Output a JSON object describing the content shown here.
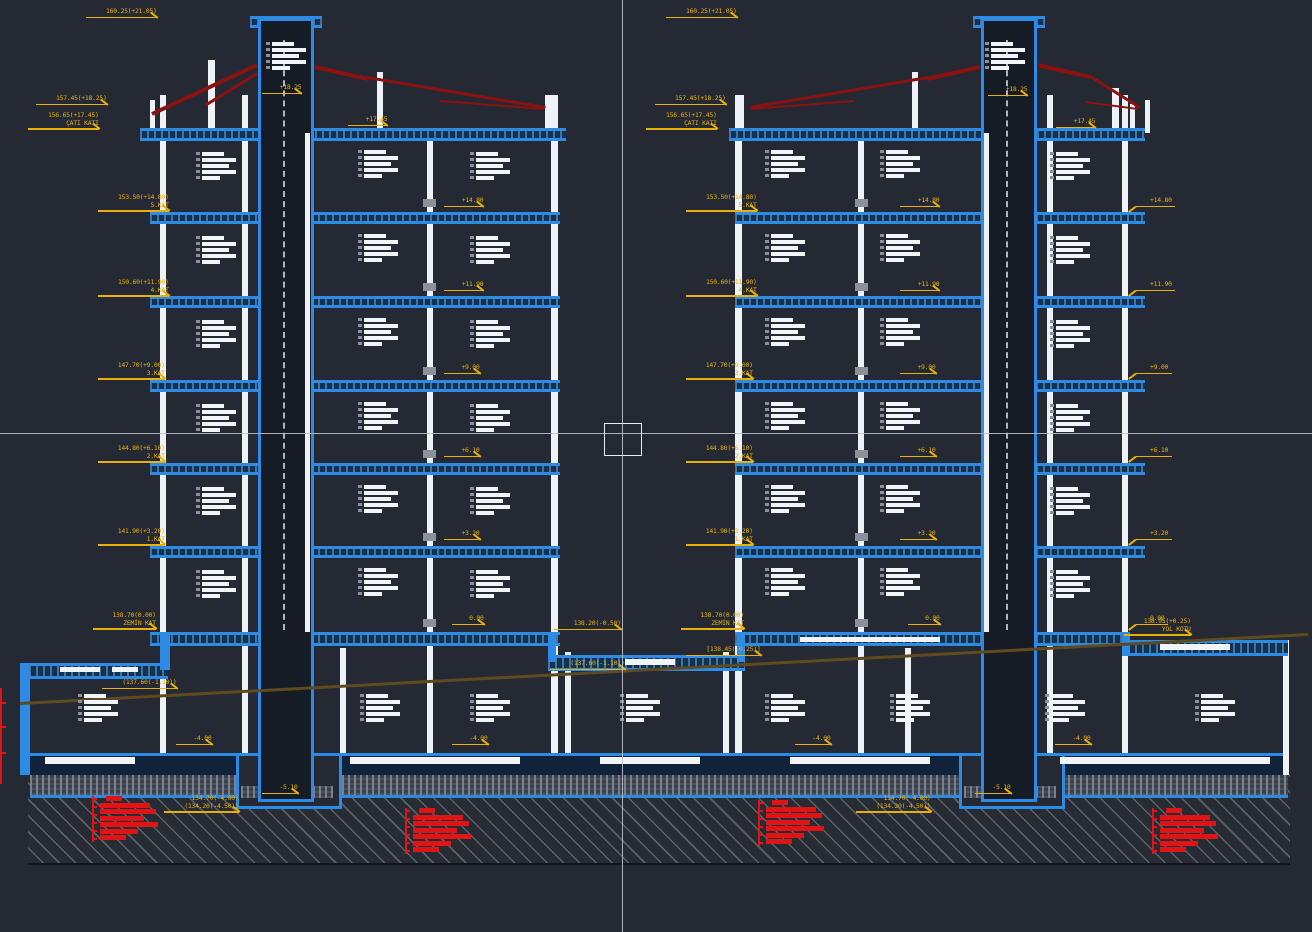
{
  "viewport": {
    "kind": "cad-section-drawing",
    "subject": "building cross-section, two mirrored tower blocks on common basement"
  },
  "colors": {
    "background": "#242933",
    "slab_blue": "#2d8ae5",
    "wall_white": "#eef1f5",
    "label_yellow": "#e9b009",
    "roof_red": "#8c1212",
    "note_red": "#e01414",
    "ground_brown": "#5f4a1f",
    "crosshair": "#b9bec8"
  },
  "cursor": {
    "x": 622,
    "y": 433
  },
  "annotations": [
    {
      "x": 86,
      "y": 8,
      "dir": "r",
      "lines": [
        "160.25(+21.05)"
      ]
    },
    {
      "x": 36,
      "y": 95,
      "dir": "r",
      "lines": [
        "157.45(+18.25)"
      ]
    },
    {
      "x": 28,
      "y": 112,
      "dir": "r",
      "lines": [
        "156.65(+17.45)",
        "ÇATI KATI"
      ]
    },
    {
      "x": 98,
      "y": 194,
      "dir": "r",
      "lines": [
        "153.50(+14.80)",
        "5.KAT"
      ]
    },
    {
      "x": 98,
      "y": 279,
      "dir": "r",
      "lines": [
        "150.60(+11.90)",
        "4.KAT"
      ]
    },
    {
      "x": 98,
      "y": 362,
      "dir": "r",
      "lines": [
        "147.70(+9.00)",
        "3.KAT"
      ]
    },
    {
      "x": 98,
      "y": 445,
      "dir": "r",
      "lines": [
        "144.80(+6.10)",
        "2.KAT"
      ]
    },
    {
      "x": 98,
      "y": 528,
      "dir": "r",
      "lines": [
        "141.90(+3.20)",
        "1.KAT"
      ]
    },
    {
      "x": 93,
      "y": 612,
      "dir": "r",
      "lines": [
        "138.70(0.00)",
        "ZEMİN KAT"
      ]
    },
    {
      "x": 102,
      "y": 679,
      "dir": "r",
      "lines": [
        "(137.60(-1.10))"
      ]
    },
    {
      "x": 164,
      "y": 795,
      "dir": "r",
      "lines": [
        "134.70(-4.00)",
        "(134.20(-4.50))"
      ]
    },
    {
      "x": 666,
      "y": 8,
      "dir": "r",
      "lines": [
        "160.25(+21.05)"
      ]
    },
    {
      "x": 655,
      "y": 95,
      "dir": "r",
      "lines": [
        "157.45(+18.25)"
      ]
    },
    {
      "x": 646,
      "y": 112,
      "dir": "r",
      "lines": [
        "156.65(+17.45)",
        "ÇATI KATI"
      ]
    },
    {
      "x": 686,
      "y": 194,
      "dir": "r",
      "lines": [
        "153.50(+14.80)",
        "5.KAT"
      ]
    },
    {
      "x": 686,
      "y": 279,
      "dir": "r",
      "lines": [
        "150.60(+11.90)",
        "4.KAT"
      ]
    },
    {
      "x": 686,
      "y": 362,
      "dir": "r",
      "lines": [
        "147.70(+9.00)",
        "3.KAT"
      ]
    },
    {
      "x": 686,
      "y": 445,
      "dir": "r",
      "lines": [
        "144.80(+6.10)",
        "2.KAT"
      ]
    },
    {
      "x": 686,
      "y": 528,
      "dir": "r",
      "lines": [
        "141.90(+3.20)",
        "1.KAT"
      ]
    },
    {
      "x": 681,
      "y": 612,
      "dir": "r",
      "lines": [
        "138.70(0.00)",
        "ZEMİN KAT"
      ]
    },
    {
      "x": 686,
      "y": 646,
      "dir": "r",
      "lines": [
        "[138.45(-0.25)]"
      ]
    },
    {
      "x": 554,
      "y": 620,
      "dir": "r",
      "lines": [
        "138.20(-0.50)"
      ]
    },
    {
      "x": 550,
      "y": 660,
      "dir": "r",
      "lines": [
        "(137.60(-1.10))"
      ]
    },
    {
      "x": 856,
      "y": 795,
      "dir": "r",
      "lines": [
        "134.70(-4.00)",
        "(134.20(-4.50))"
      ]
    },
    {
      "x": 1124,
      "y": 618,
      "dir": "r",
      "lines": [
        "138.95(+0.25)",
        "YOL KOTU"
      ]
    },
    {
      "x": 444,
      "y": 197,
      "dir": "r",
      "lines": [
        "+14.80"
      ]
    },
    {
      "x": 444,
      "y": 281,
      "dir": "r",
      "lines": [
        "+11.90"
      ]
    },
    {
      "x": 444,
      "y": 364,
      "dir": "r",
      "lines": [
        "+9.00"
      ]
    },
    {
      "x": 444,
      "y": 447,
      "dir": "r",
      "lines": [
        "+6.10"
      ]
    },
    {
      "x": 444,
      "y": 530,
      "dir": "r",
      "lines": [
        "+3.20"
      ]
    },
    {
      "x": 452,
      "y": 615,
      "dir": "r",
      "lines": [
        "0.00"
      ]
    },
    {
      "x": 900,
      "y": 197,
      "dir": "r",
      "lines": [
        "+14.80"
      ]
    },
    {
      "x": 900,
      "y": 281,
      "dir": "r",
      "lines": [
        "+11.90"
      ]
    },
    {
      "x": 900,
      "y": 364,
      "dir": "r",
      "lines": [
        "+9.00"
      ]
    },
    {
      "x": 900,
      "y": 447,
      "dir": "r",
      "lines": [
        "+6.10"
      ]
    },
    {
      "x": 900,
      "y": 530,
      "dir": "r",
      "lines": [
        "+3.20"
      ]
    },
    {
      "x": 908,
      "y": 615,
      "dir": "r",
      "lines": [
        "0.00"
      ]
    },
    {
      "x": 1150,
      "y": 197,
      "dir": "l",
      "lines": [
        "+14.80"
      ]
    },
    {
      "x": 1150,
      "y": 281,
      "dir": "l",
      "lines": [
        "+11.90"
      ]
    },
    {
      "x": 1150,
      "y": 364,
      "dir": "l",
      "lines": [
        "+9.00"
      ]
    },
    {
      "x": 1150,
      "y": 447,
      "dir": "l",
      "lines": [
        "+6.10"
      ]
    },
    {
      "x": 1150,
      "y": 530,
      "dir": "l",
      "lines": [
        "+3.20"
      ]
    },
    {
      "x": 1150,
      "y": 615,
      "dir": "l",
      "lines": [
        "0.00"
      ]
    },
    {
      "x": 262,
      "y": 84,
      "dir": "r",
      "lines": [
        "+18.25"
      ]
    },
    {
      "x": 348,
      "y": 116,
      "dir": "r",
      "lines": [
        "+17.45"
      ]
    },
    {
      "x": 988,
      "y": 86,
      "dir": "r",
      "lines": [
        "+18.25"
      ]
    },
    {
      "x": 1056,
      "y": 118,
      "dir": "r",
      "lines": [
        "+17.45"
      ]
    },
    {
      "x": 176,
      "y": 735,
      "dir": "r",
      "lines": [
        "-4.00"
      ]
    },
    {
      "x": 452,
      "y": 735,
      "dir": "r",
      "lines": [
        "-4.00"
      ]
    },
    {
      "x": 795,
      "y": 735,
      "dir": "r",
      "lines": [
        "-4.00"
      ]
    },
    {
      "x": 1055,
      "y": 735,
      "dir": "r",
      "lines": [
        "-4.00"
      ]
    },
    {
      "x": 262,
      "y": 784,
      "dir": "r",
      "lines": [
        "-5.10"
      ]
    },
    {
      "x": 975,
      "y": 784,
      "dir": "r",
      "lines": [
        "-5.10"
      ]
    }
  ]
}
